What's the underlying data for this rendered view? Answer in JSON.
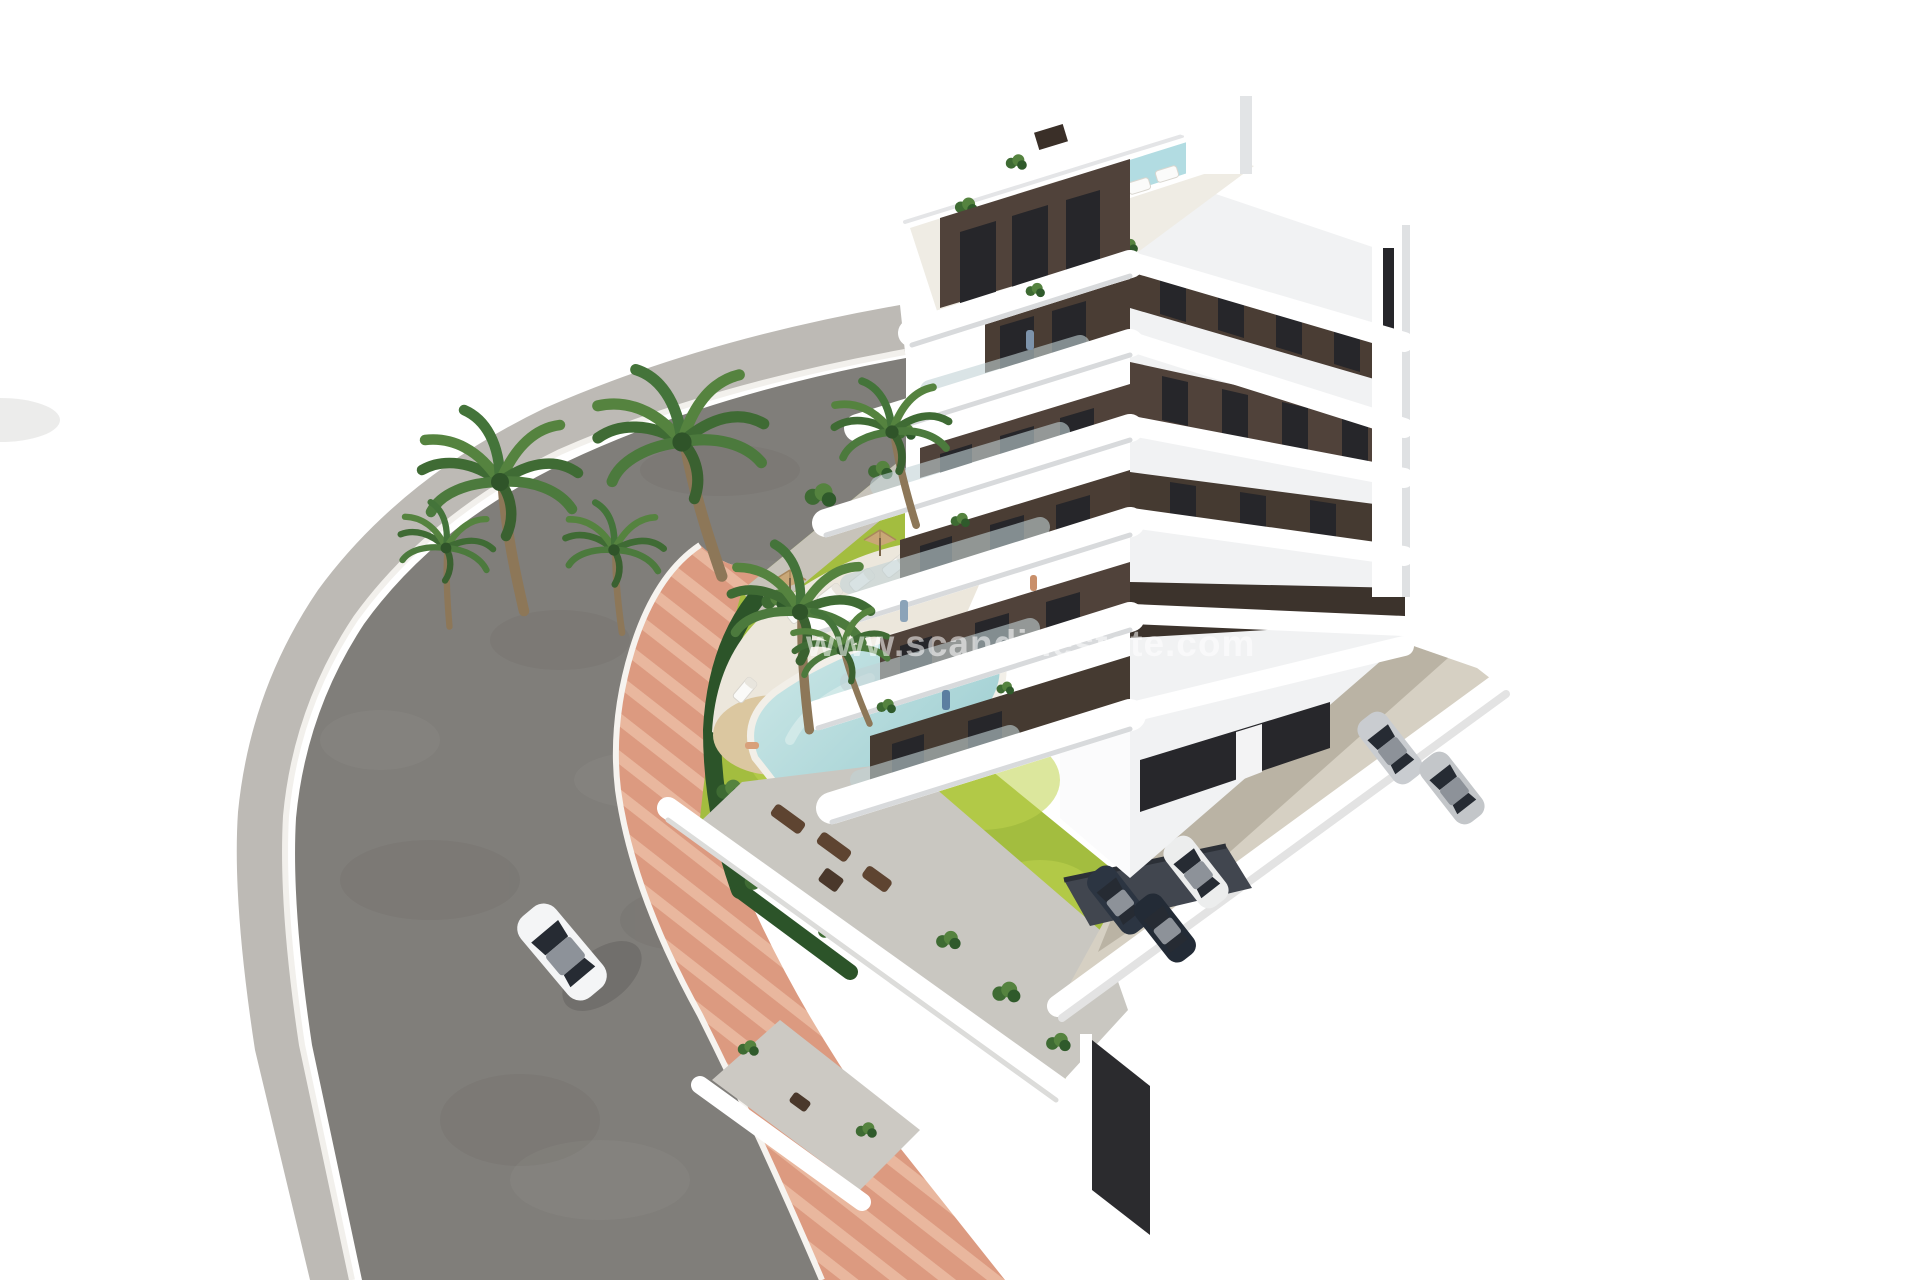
{
  "watermark": {
    "text": "www.scandinestate.com"
  },
  "scene": {
    "type": "3d-architectural-render",
    "subject": "modern-apartment-building-with-pool-garden",
    "objects": [
      "apartment-building",
      "rooftop-terrace",
      "rooftop-pool",
      "swimming-pool",
      "pool-deck",
      "sun-loungers",
      "parasols",
      "garden-lawn",
      "palm-trees",
      "hedge",
      "asphalt-road",
      "outer-sidewalk",
      "pink-walkway",
      "white-car",
      "parking-area",
      "parked-cars",
      "carport",
      "ground-floor-terrace"
    ],
    "palette": {
      "background": "#ffffff",
      "asphalt": "#807e7a",
      "outer_sidewalk": "#bdbab5",
      "pink_walkway": "#dc9a80",
      "pink_walkway_light": "#e9b79e",
      "lawn": "#a3bd3f",
      "lawn_light": "#c0d44e",
      "pool_water": "#9cccd0",
      "pool_water_light": "#cde8e8",
      "sand": "#dbc7a0",
      "pool_deck": "#ece7dc",
      "hedge": "#2c5429",
      "palm_green": "#4c7a3d",
      "palm_trunk": "#8d7758",
      "facade_white": "#ffffff",
      "facade_brown": "#50423a",
      "window_glass": "#26262a",
      "glass_balustrade": "#c2d2d6",
      "rooftop_floor": "#efece4",
      "rooftop_pool": "#b2dce2",
      "terrace_concrete": "#c9c7c1",
      "parking_concrete": "#d6d0c3",
      "parking_shadow": "#b5ae9f",
      "car_white": "#f4f5f6",
      "car_silver": "#c9ccd0",
      "car_navy": "#2c3542",
      "furniture_brown": "#5e4431"
    }
  }
}
